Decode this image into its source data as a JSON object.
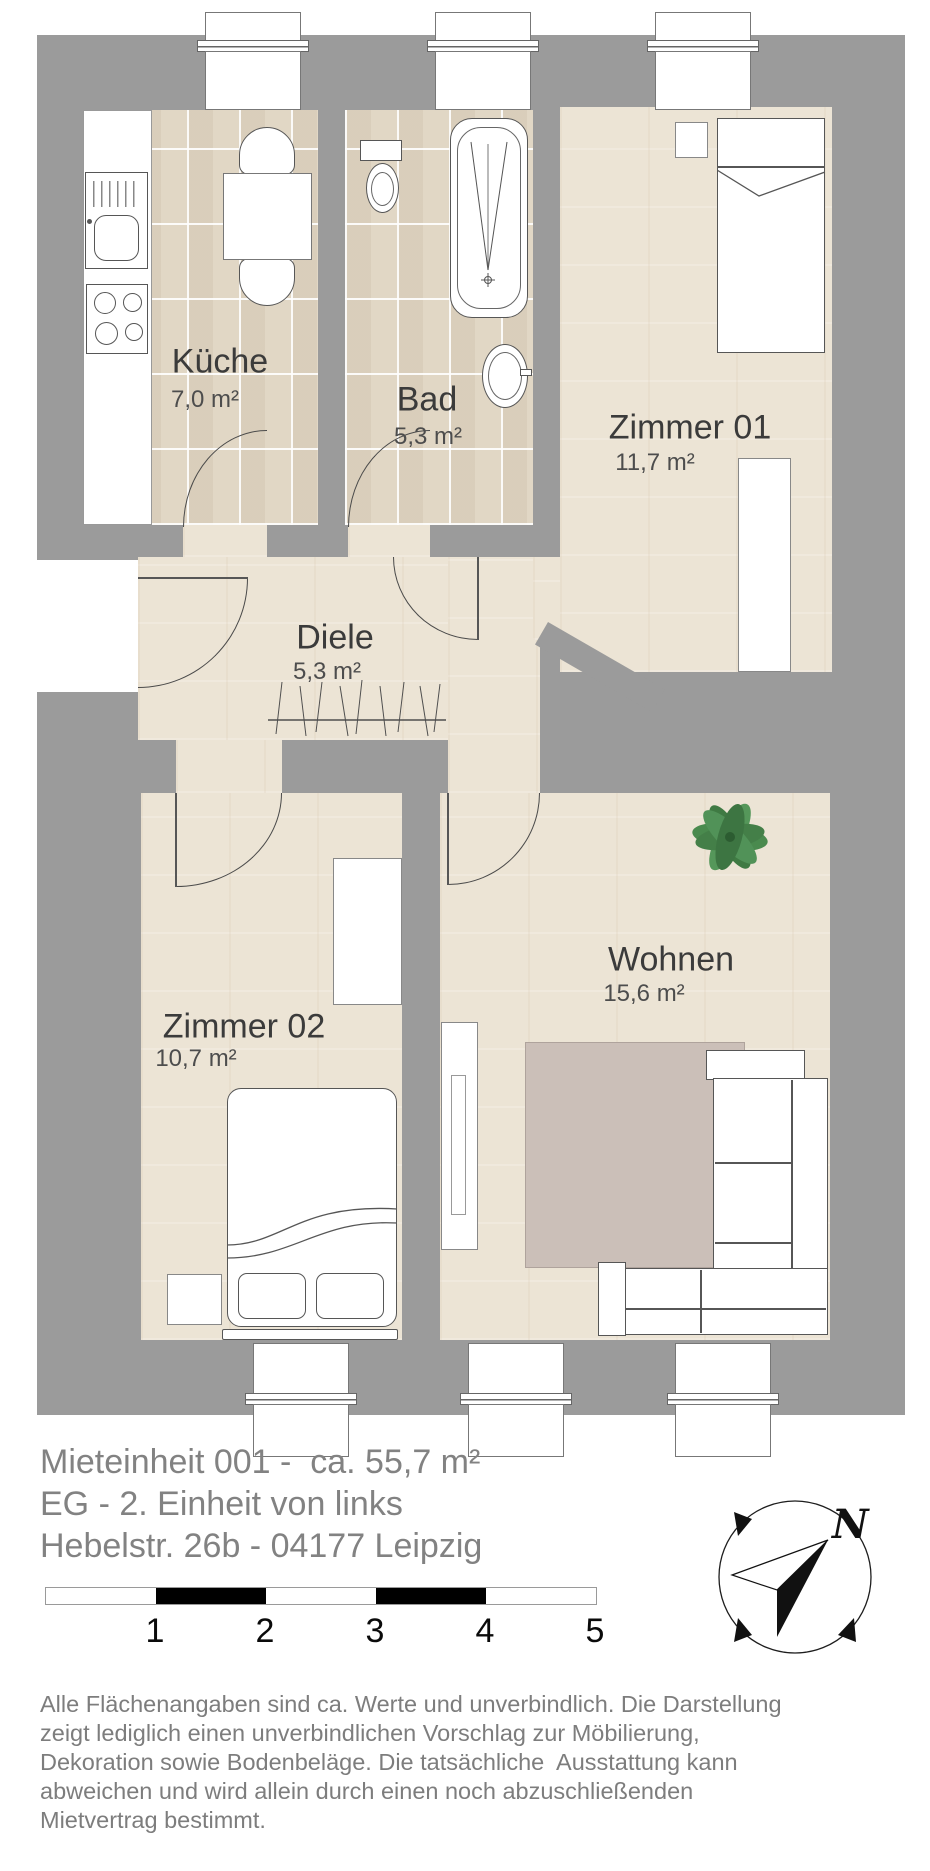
{
  "rooms": {
    "kueche": {
      "name": "Küche",
      "area": "7,0 m²"
    },
    "bad": {
      "name": "Bad",
      "area": "5,3 m²"
    },
    "zimmer01": {
      "name": "Zimmer 01",
      "area": "11,7 m²"
    },
    "diele": {
      "name": "Diele",
      "area": "5,3 m²"
    },
    "zimmer02": {
      "name": "Zimmer 02",
      "area": "10,7 m²"
    },
    "wohnen": {
      "name": "Wohnen",
      "area": "15,6 m²"
    }
  },
  "title_block": {
    "line1": "Mieteinheit 001 -  ca. 55,7 m²",
    "line2": "EG - 2. Einheit von links",
    "line3": "Hebelstr. 26b - 04177 Leipzig"
  },
  "scale_bar": {
    "labels": [
      "1",
      "2",
      "3",
      "4",
      "5"
    ]
  },
  "compass": {
    "north_label": "N"
  },
  "disclaimer": {
    "line1": "Alle Flächenangaben sind ca. Werte und unverbindlich. Die Darstellung",
    "line2": "zeigt lediglich einen unverbindlichen Vorschlag zur Möbilierung,",
    "line3": "Dekoration sowie Bodenbeläge. Die tatsächliche  Ausstattung kann",
    "line4": "abweichen und wird allein durch einen noch abzuschließenden",
    "line5": "Mietvertrag bestimmt."
  },
  "colors": {
    "wall": "#9b9b9b",
    "wood": "#ece4d5",
    "tile": "#e1d7c5",
    "rug": "#cbbfb8",
    "title_text": "#828282",
    "disclaimer_text": "#7d7d7d",
    "room_text": "#3b3b3b"
  }
}
